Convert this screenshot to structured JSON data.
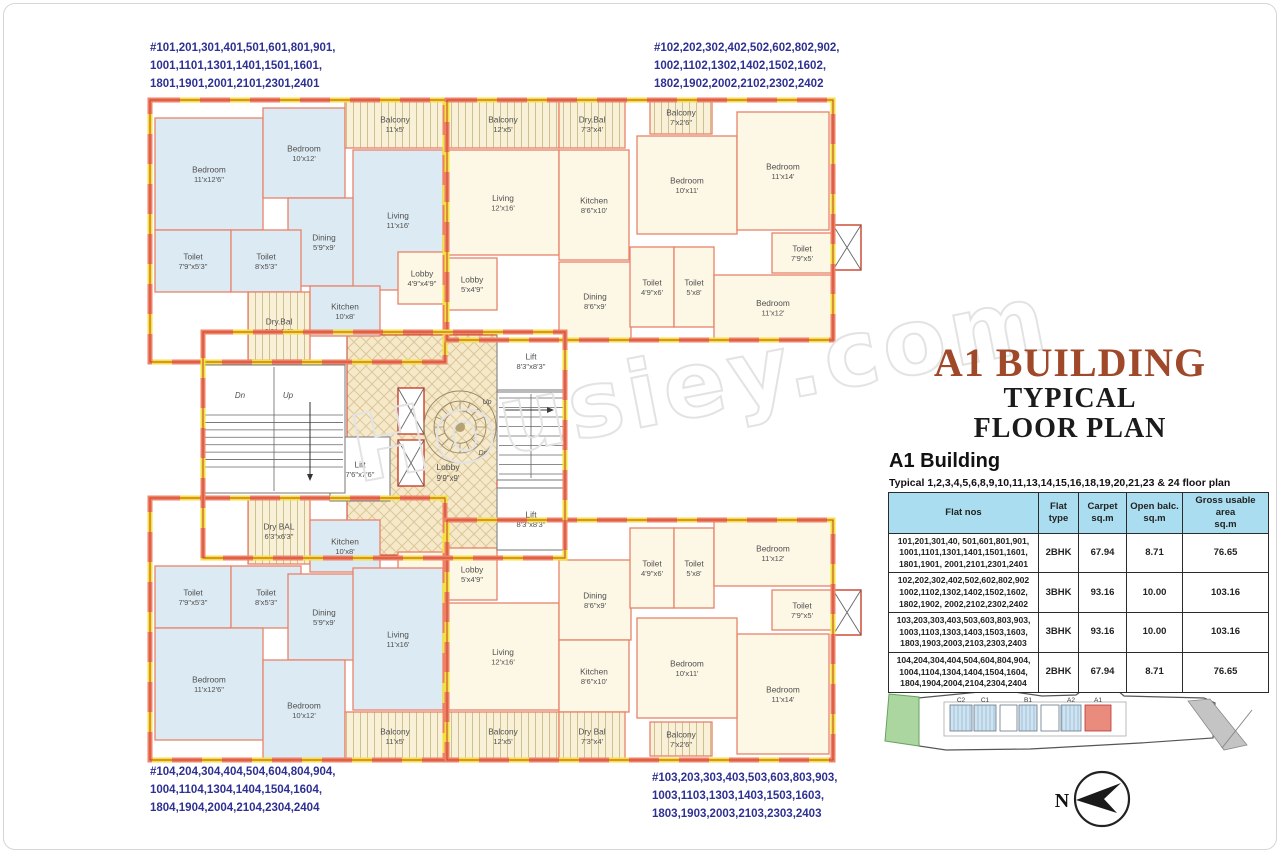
{
  "page_title": {
    "line1": "A1 BUILDING",
    "line2": "TYPICAL",
    "line3": "FLOOR PLAN"
  },
  "colors": {
    "title_accent": "#a0482a",
    "flat_label_blue": "#2e3192",
    "table_header_bg": "#a9ddef",
    "site_highlight": "#e98b7d"
  },
  "watermark": "Housiey.com",
  "corner_labels": {
    "top_left": "#101,201,301,401,501,601,801,901,\n1001,1101,1301,1401,1501,1601,\n1801,1901,2001,2101,2301,2401",
    "top_right": "#102,202,302,402,502,602,802,902,\n1002,1102,1302,1402,1502,1602,\n1802,1902,2002,2102,2302,2402",
    "bottom_left": "#104,204,304,404,504,604,804,904,\n1004,1104,1304,1404,1504,1604,\n1804,1904,2004,2104,2304,2404",
    "bottom_right": "#103,203,303,403,503,603,803,903,\n1003,1103,1303,1403,1503,1603,\n1803,1903,2003,2103,2303,2403"
  },
  "building_info": {
    "heading": "A1 Building",
    "subtitle": "Typical 1,2,3,4,5,6,8,9,10,11,13,14,15,16,18,19,20,21,23 & 24 floor plan"
  },
  "table": {
    "headers": [
      "Flat nos",
      "Flat\ntype",
      "Carpet\nsq.m",
      "Open balc.\nsq.m",
      "Gross usable area\nsq.m"
    ],
    "rows": [
      {
        "flats": "101,201,301,40, 501,601,801,901,\n1001,1101,1301,1401,1501,1601,\n1801,1901, 2001,2101,2301,2401",
        "type": "2BHK",
        "carpet": "67.94",
        "balc": "8.71",
        "gross": "76.65"
      },
      {
        "flats": "102,202,302,402,502,602,802,902\n1002,1102,1302,1402,1502,1602,\n1802,1902, 2002,2102,2302,2402",
        "type": "3BHK",
        "carpet": "93.16",
        "balc": "10.00",
        "gross": "103.16"
      },
      {
        "flats": "103,203,303,403,503,603,803,903,\n1003,1103,1303,1403,1503,1603,\n1803,1903,2003,2103,2303,2403",
        "type": "3BHK",
        "carpet": "93.16",
        "balc": "10.00",
        "gross": "103.16"
      },
      {
        "flats": "104,204,304,404,504,604,804,904,\n1004,1104,1304,1404,1504,1604,\n1804,1904,2004,2104,2304,2404",
        "type": "2BHK",
        "carpet": "67.94",
        "balc": "8.71",
        "gross": "76.65"
      }
    ]
  },
  "site_plan": {
    "highlight_color": "#e98b7d",
    "buildings": [
      {
        "l": "C2",
        "x": 950,
        "w": 22,
        "t": "hatch"
      },
      {
        "l": "C1",
        "x": 974,
        "w": 22,
        "t": "hatch"
      },
      {
        "l": "",
        "x": 1000,
        "w": 17,
        "t": "plain"
      },
      {
        "l": "B1",
        "x": 1019,
        "w": 18,
        "t": "hatch"
      },
      {
        "l": "",
        "x": 1041,
        "w": 18,
        "t": "plain"
      },
      {
        "l": "A2",
        "x": 1061,
        "w": 20,
        "t": "hatch"
      },
      {
        "l": "A1",
        "x": 1085,
        "w": 26,
        "t": "red"
      }
    ]
  },
  "compass": {
    "north_label": "N"
  },
  "floor_plan": {
    "colors": {
      "wall_orange": "#ef8265",
      "wall_yellow": "#f1e23d",
      "wall_line": "#c8402a",
      "room_line": "#e8826a",
      "room_blue": "#dcebf3",
      "room_cream": "#fdf8e6"
    },
    "units": [
      {
        "x": 150,
        "y": 100,
        "w": 295,
        "h": 262
      },
      {
        "x": 447,
        "y": 100,
        "w": 386,
        "h": 240
      },
      {
        "x": 150,
        "y": 498,
        "w": 295,
        "h": 262
      },
      {
        "x": 447,
        "y": 520,
        "w": 386,
        "h": 240
      },
      {
        "x": 203,
        "y": 332,
        "w": 362,
        "h": 226
      }
    ],
    "core": {
      "x": 347,
      "y": 335,
      "w": 150,
      "h": 220
    },
    "rooms": [
      {
        "l": "Bedroom",
        "d": "11'x12'6\"",
        "x": 155,
        "y": 118,
        "w": 108,
        "h": 112,
        "f": "b"
      },
      {
        "l": "Bedroom",
        "d": "10'x12'",
        "x": 263,
        "y": 108,
        "w": 82,
        "h": 90,
        "f": "b"
      },
      {
        "l": "Balcony",
        "d": "11'x5'",
        "x": 345,
        "y": 100,
        "w": 100,
        "h": 48,
        "f": "h"
      },
      {
        "l": "Dining",
        "d": "5'9\"x9'",
        "x": 288,
        "y": 198,
        "w": 72,
        "h": 88,
        "f": "b"
      },
      {
        "l": "Living",
        "d": "11'x16'",
        "x": 353,
        "y": 150,
        "w": 90,
        "h": 140,
        "f": "b"
      },
      {
        "l": "Toilet",
        "d": "7'9\"x5'3\"",
        "x": 155,
        "y": 230,
        "w": 76,
        "h": 62,
        "f": "b"
      },
      {
        "l": "Toilet",
        "d": "8'x5'3\"",
        "x": 231,
        "y": 230,
        "w": 70,
        "h": 62,
        "f": "b"
      },
      {
        "l": "Dry.Bal",
        "d": "6'3\"x6'3\"",
        "x": 248,
        "y": 292,
        "w": 62,
        "h": 68,
        "f": "h"
      },
      {
        "l": "Kitchen",
        "d": "10'x8'",
        "x": 310,
        "y": 286,
        "w": 70,
        "h": 50,
        "f": "b"
      },
      {
        "l": "Lobby",
        "d": "4'9\"x4'9\"",
        "x": 398,
        "y": 252,
        "w": 48,
        "h": 52,
        "f": "c"
      },
      {
        "l": "Balcony",
        "d": "12'x5'",
        "x": 447,
        "y": 100,
        "w": 112,
        "h": 48,
        "f": "h"
      },
      {
        "l": "Dry.Bal",
        "d": "7'3\"x4'",
        "x": 559,
        "y": 100,
        "w": 66,
        "h": 48,
        "f": "h"
      },
      {
        "l": "Living",
        "d": "12'x16'",
        "x": 447,
        "y": 150,
        "w": 112,
        "h": 105,
        "f": "c"
      },
      {
        "l": "Kitchen",
        "d": "8'6\"x10'",
        "x": 559,
        "y": 150,
        "w": 70,
        "h": 110,
        "f": "c"
      },
      {
        "l": "Dining",
        "d": "8'6\"x9'",
        "x": 559,
        "y": 262,
        "w": 72,
        "h": 78,
        "f": "c"
      },
      {
        "l": "Lobby",
        "d": "5'x4'9\"",
        "x": 447,
        "y": 258,
        "w": 50,
        "h": 52,
        "f": "c"
      },
      {
        "l": "Balcony",
        "d": "7'x2'6\"",
        "x": 650,
        "y": 100,
        "w": 62,
        "h": 34,
        "f": "h"
      },
      {
        "l": "Bedroom",
        "d": "10'x11'",
        "x": 637,
        "y": 136,
        "w": 100,
        "h": 98,
        "f": "c"
      },
      {
        "l": "Bedroom",
        "d": "11'x14'",
        "x": 737,
        "y": 112,
        "w": 92,
        "h": 118,
        "f": "c"
      },
      {
        "l": "Toilet",
        "d": "7'9\"x5'",
        "x": 772,
        "y": 233,
        "w": 60,
        "h": 40,
        "f": "c"
      },
      {
        "l": "Toilet",
        "d": "4'9\"x6'",
        "x": 630,
        "y": 247,
        "w": 44,
        "h": 80,
        "f": "c"
      },
      {
        "l": "Toilet",
        "d": "5'x8'",
        "x": 674,
        "y": 247,
        "w": 40,
        "h": 80,
        "f": "c"
      },
      {
        "l": "Bedroom",
        "d": "11'x12'",
        "x": 714,
        "y": 275,
        "w": 118,
        "h": 65,
        "f": "c"
      },
      {
        "l": "Dry BAL",
        "d": "6'3\"x6'3\"",
        "x": 248,
        "y": 498,
        "w": 62,
        "h": 66,
        "f": "h"
      },
      {
        "l": "Kitchen",
        "d": "10'x8'",
        "x": 310,
        "y": 520,
        "w": 70,
        "h": 52,
        "f": "b"
      },
      {
        "l": "Lobby",
        "d": "4'9\"x4'9\"",
        "x": 398,
        "y": 552,
        "w": 48,
        "h": 52,
        "f": "c"
      },
      {
        "l": "Toilet",
        "d": "7'9\"x5'3\"",
        "x": 155,
        "y": 566,
        "w": 76,
        "h": 62,
        "f": "b"
      },
      {
        "l": "Toilet",
        "d": "8'x5'3\"",
        "x": 231,
        "y": 566,
        "w": 70,
        "h": 62,
        "f": "b"
      },
      {
        "l": "Dining",
        "d": "5'9\"x9'",
        "x": 288,
        "y": 574,
        "w": 72,
        "h": 86,
        "f": "b"
      },
      {
        "l": "Living",
        "d": "11'x16'",
        "x": 353,
        "y": 568,
        "w": 90,
        "h": 142,
        "f": "b"
      },
      {
        "l": "Bedroom",
        "d": "11'x12'6\"",
        "x": 155,
        "y": 628,
        "w": 108,
        "h": 112,
        "f": "b"
      },
      {
        "l": "Bedroom",
        "d": "10'x12'",
        "x": 263,
        "y": 660,
        "w": 82,
        "h": 100,
        "f": "b"
      },
      {
        "l": "Balcony",
        "d": "11'x5'",
        "x": 345,
        "y": 712,
        "w": 100,
        "h": 48,
        "f": "h"
      },
      {
        "l": "Lobby",
        "d": "5'x4'9\"",
        "x": 447,
        "y": 548,
        "w": 50,
        "h": 52,
        "f": "c"
      },
      {
        "l": "Living",
        "d": "12'x16'",
        "x": 447,
        "y": 603,
        "w": 112,
        "h": 107,
        "f": "c"
      },
      {
        "l": "Dining",
        "d": "8'6\"x9'",
        "x": 559,
        "y": 560,
        "w": 72,
        "h": 80,
        "f": "c"
      },
      {
        "l": "Kitchen",
        "d": "8'6\"x10'",
        "x": 559,
        "y": 640,
        "w": 70,
        "h": 72,
        "f": "c"
      },
      {
        "l": "Balcony",
        "d": "12'x5'",
        "x": 447,
        "y": 712,
        "w": 112,
        "h": 48,
        "f": "h"
      },
      {
        "l": "Dry Bal",
        "d": "7'3\"x4'",
        "x": 559,
        "y": 712,
        "w": 66,
        "h": 48,
        "f": "h"
      },
      {
        "l": "Toilet",
        "d": "4'9\"x6'",
        "x": 630,
        "y": 528,
        "w": 44,
        "h": 80,
        "f": "c"
      },
      {
        "l": "Toilet",
        "d": "5'x8'",
        "x": 674,
        "y": 528,
        "w": 40,
        "h": 80,
        "f": "c"
      },
      {
        "l": "Bedroom",
        "d": "11'x12'",
        "x": 714,
        "y": 520,
        "w": 118,
        "h": 66,
        "f": "c"
      },
      {
        "l": "Toilet",
        "d": "7'9\"x5'",
        "x": 772,
        "y": 590,
        "w": 60,
        "h": 40,
        "f": "c"
      },
      {
        "l": "Bedroom",
        "d": "11'x14'",
        "x": 737,
        "y": 634,
        "w": 92,
        "h": 120,
        "f": "c"
      },
      {
        "l": "Bedroom",
        "d": "10'x11'",
        "x": 637,
        "y": 618,
        "w": 100,
        "h": 100,
        "f": "c"
      },
      {
        "l": "Balcony",
        "d": "7'x2'6\"",
        "x": 650,
        "y": 722,
        "w": 62,
        "h": 34,
        "f": "h"
      }
    ],
    "lifts": [
      {
        "l": "Lift",
        "d": "8'3\"x8'3\"",
        "x": 497,
        "y": 332,
        "w": 68,
        "h": 58
      },
      {
        "l": "Lift",
        "d": "8'3\"x8'3\"",
        "x": 497,
        "y": 488,
        "w": 68,
        "h": 62
      },
      {
        "l": "Lift",
        "d": "7'6\"x7'6\"",
        "x": 330,
        "y": 437,
        "w": 60,
        "h": 64
      }
    ],
    "stairs": [
      {
        "x": 203,
        "y": 365,
        "w": 142,
        "h": 128,
        "t0": 50,
        "t1": 102,
        "n": 7,
        "a": [
          310,
          402,
          310,
          480
        ]
      },
      {
        "x": 497,
        "y": 392,
        "w": 68,
        "h": 88,
        "t0": 6,
        "t1": 82,
        "n": 8,
        "a": [
          505,
          410,
          553,
          410
        ]
      }
    ],
    "shafts": [
      {
        "x": 398,
        "y": 388,
        "w": 26,
        "h": 46
      },
      {
        "x": 398,
        "y": 440,
        "w": 26,
        "h": 46
      },
      {
        "x": 833,
        "y": 225,
        "w": 28,
        "h": 45
      },
      {
        "x": 833,
        "y": 590,
        "w": 28,
        "h": 45
      }
    ],
    "mandala": {
      "cx": 460,
      "cy": 427,
      "r": 36
    },
    "texts": [
      {
        "t": "Dn",
        "x": 240,
        "y": 398,
        "s": 8,
        "i": true
      },
      {
        "t": "Up",
        "x": 288,
        "y": 398,
        "s": 8,
        "i": true
      },
      {
        "t": "Up",
        "x": 487,
        "y": 404,
        "s": 7,
        "i": true
      },
      {
        "t": "Dn",
        "x": 483,
        "y": 455,
        "s": 7,
        "i": true
      },
      {
        "t": "Lobby",
        "x": 448,
        "y": 470,
        "s": 8.5
      },
      {
        "t": "9'9\"x9'",
        "x": 448,
        "y": 481,
        "s": 7.8
      }
    ]
  }
}
